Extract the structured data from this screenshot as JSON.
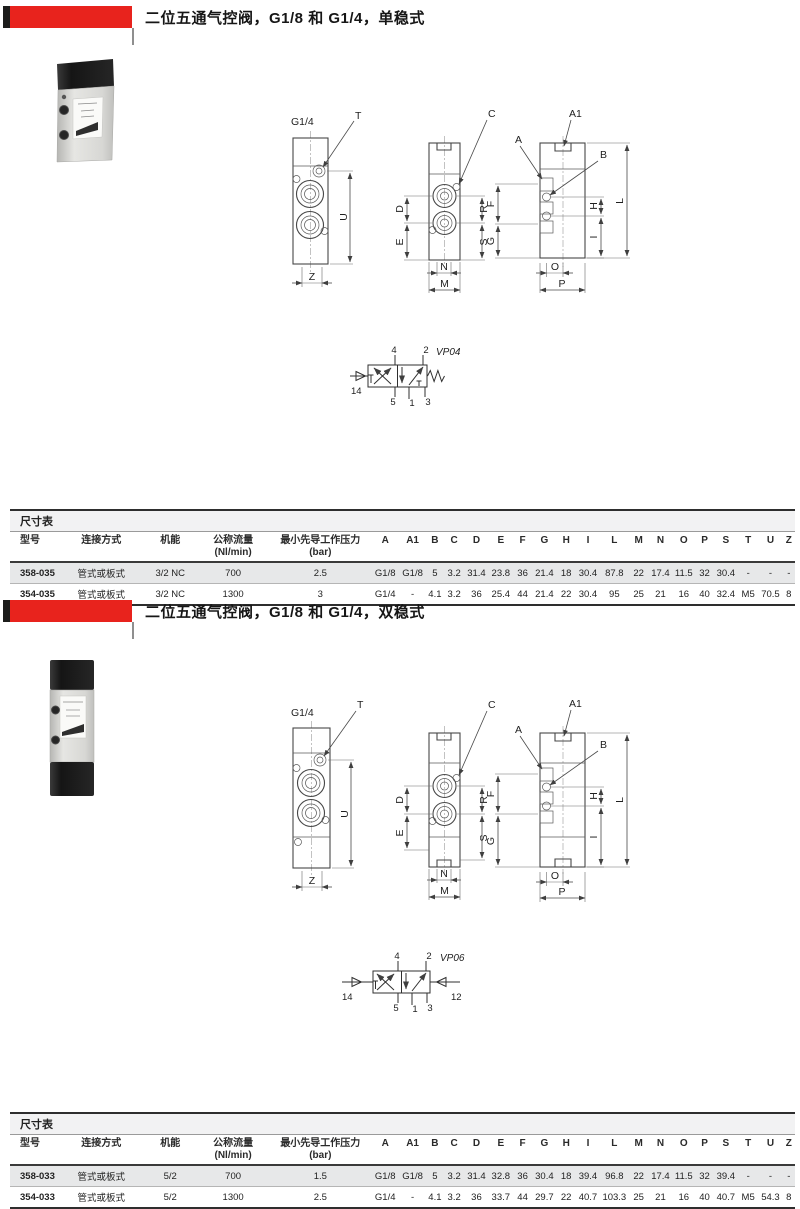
{
  "colors": {
    "accent_red": "#e8231d",
    "bar_black": "#1d1d1b",
    "row_alt": "#e7e8e9",
    "line_dark": "#2e2e2e"
  },
  "sections": [
    {
      "title": "二位五通气控阀，G1/8 和 G1/4，单稳式",
      "drawing": {
        "port": "G1/4",
        "labels": {
          "t": "T",
          "u": "U",
          "z": "Z",
          "c": "C",
          "d": "D",
          "e": "E",
          "r": "R",
          "s": "S",
          "n": "N",
          "m": "M",
          "a": "A",
          "a1": "A1",
          "b": "B",
          "f": "F",
          "g": "G",
          "h": "H",
          "i": "I",
          "l": "L",
          "o": "O",
          "p": "P"
        }
      },
      "symbol": {
        "name": "VP04",
        "pilot_left": "14",
        "ports_top": [
          "4",
          "2"
        ],
        "ports_bottom": [
          "5",
          "1",
          "3"
        ]
      },
      "table": {
        "caption": "尺寸表",
        "col_model": "型号",
        "col_connection": "连接方式",
        "col_function": "机能",
        "col_flow": "公称流量",
        "col_flow_unit": "(Nl/min)",
        "col_pressure": "最小先导工作压力",
        "col_pressure_unit": "(bar)",
        "dim_cols": [
          "A",
          "A1",
          "B",
          "C",
          "D",
          "E",
          "F",
          "G",
          "H",
          "I",
          "L",
          "M",
          "N",
          "O",
          "P",
          "S",
          "T",
          "U",
          "Z"
        ],
        "rows": [
          {
            "model": "358-035",
            "connection": "管式或板式",
            "function": "3/2 NC",
            "flow": "700",
            "pressure": "2.5",
            "dims": [
              "G1/8",
              "G1/8",
              "5",
              "3.2",
              "31.4",
              "23.8",
              "36",
              "21.4",
              "18",
              "30.4",
              "87.8",
              "22",
              "17.4",
              "11.5",
              "32",
              "30.4",
              "-",
              "-",
              "-"
            ]
          },
          {
            "model": "354-035",
            "connection": "管式或板式",
            "function": "3/2 NC",
            "flow": "1300",
            "pressure": "3",
            "dims": [
              "G1/4",
              "-",
              "4.1",
              "3.2",
              "36",
              "25.4",
              "44",
              "21.4",
              "22",
              "30.4",
              "95",
              "25",
              "21",
              "16",
              "40",
              "32.4",
              "M5",
              "70.5",
              "8"
            ]
          }
        ]
      }
    },
    {
      "title": "二位五通气控阀，G1/8 和 G1/4，双稳式",
      "drawing": {
        "port": "G1/4",
        "labels": {
          "t": "T",
          "u": "U",
          "z": "Z",
          "c": "C",
          "d": "D",
          "e": "E",
          "r": "R",
          "s": "S",
          "n": "N",
          "m": "M",
          "a": "A",
          "a1": "A1",
          "b": "B",
          "f": "F",
          "g": "G",
          "h": "H",
          "i": "I",
          "l": "L",
          "o": "O",
          "p": "P"
        }
      },
      "symbol": {
        "name": "VP06",
        "pilot_left": "14",
        "pilot_right": "12",
        "ports_top": [
          "4",
          "2"
        ],
        "ports_bottom": [
          "5",
          "1",
          "3"
        ]
      },
      "table": {
        "caption": "尺寸表",
        "col_model": "型号",
        "col_connection": "连接方式",
        "col_function": "机能",
        "col_flow": "公称流量",
        "col_flow_unit": "(Nl/min)",
        "col_pressure": "最小先导工作压力",
        "col_pressure_unit": "(bar)",
        "dim_cols": [
          "A",
          "A1",
          "B",
          "C",
          "D",
          "E",
          "F",
          "G",
          "H",
          "I",
          "L",
          "M",
          "N",
          "O",
          "P",
          "S",
          "T",
          "U",
          "Z"
        ],
        "rows": [
          {
            "model": "358-033",
            "connection": "管式或板式",
            "function": "5/2",
            "flow": "700",
            "pressure": "1.5",
            "dims": [
              "G1/8",
              "G1/8",
              "5",
              "3.2",
              "31.4",
              "32.8",
              "36",
              "30.4",
              "18",
              "39.4",
              "96.8",
              "22",
              "17.4",
              "11.5",
              "32",
              "39.4",
              "-",
              "-",
              "-"
            ]
          },
          {
            "model": "354-033",
            "connection": "管式或板式",
            "function": "5/2",
            "flow": "1300",
            "pressure": "2.5",
            "dims": [
              "G1/4",
              "-",
              "4.1",
              "3.2",
              "36",
              "33.7",
              "44",
              "29.7",
              "22",
              "40.7",
              "103.3",
              "25",
              "21",
              "16",
              "40",
              "40.7",
              "M5",
              "54.3",
              "8"
            ]
          }
        ]
      }
    }
  ]
}
